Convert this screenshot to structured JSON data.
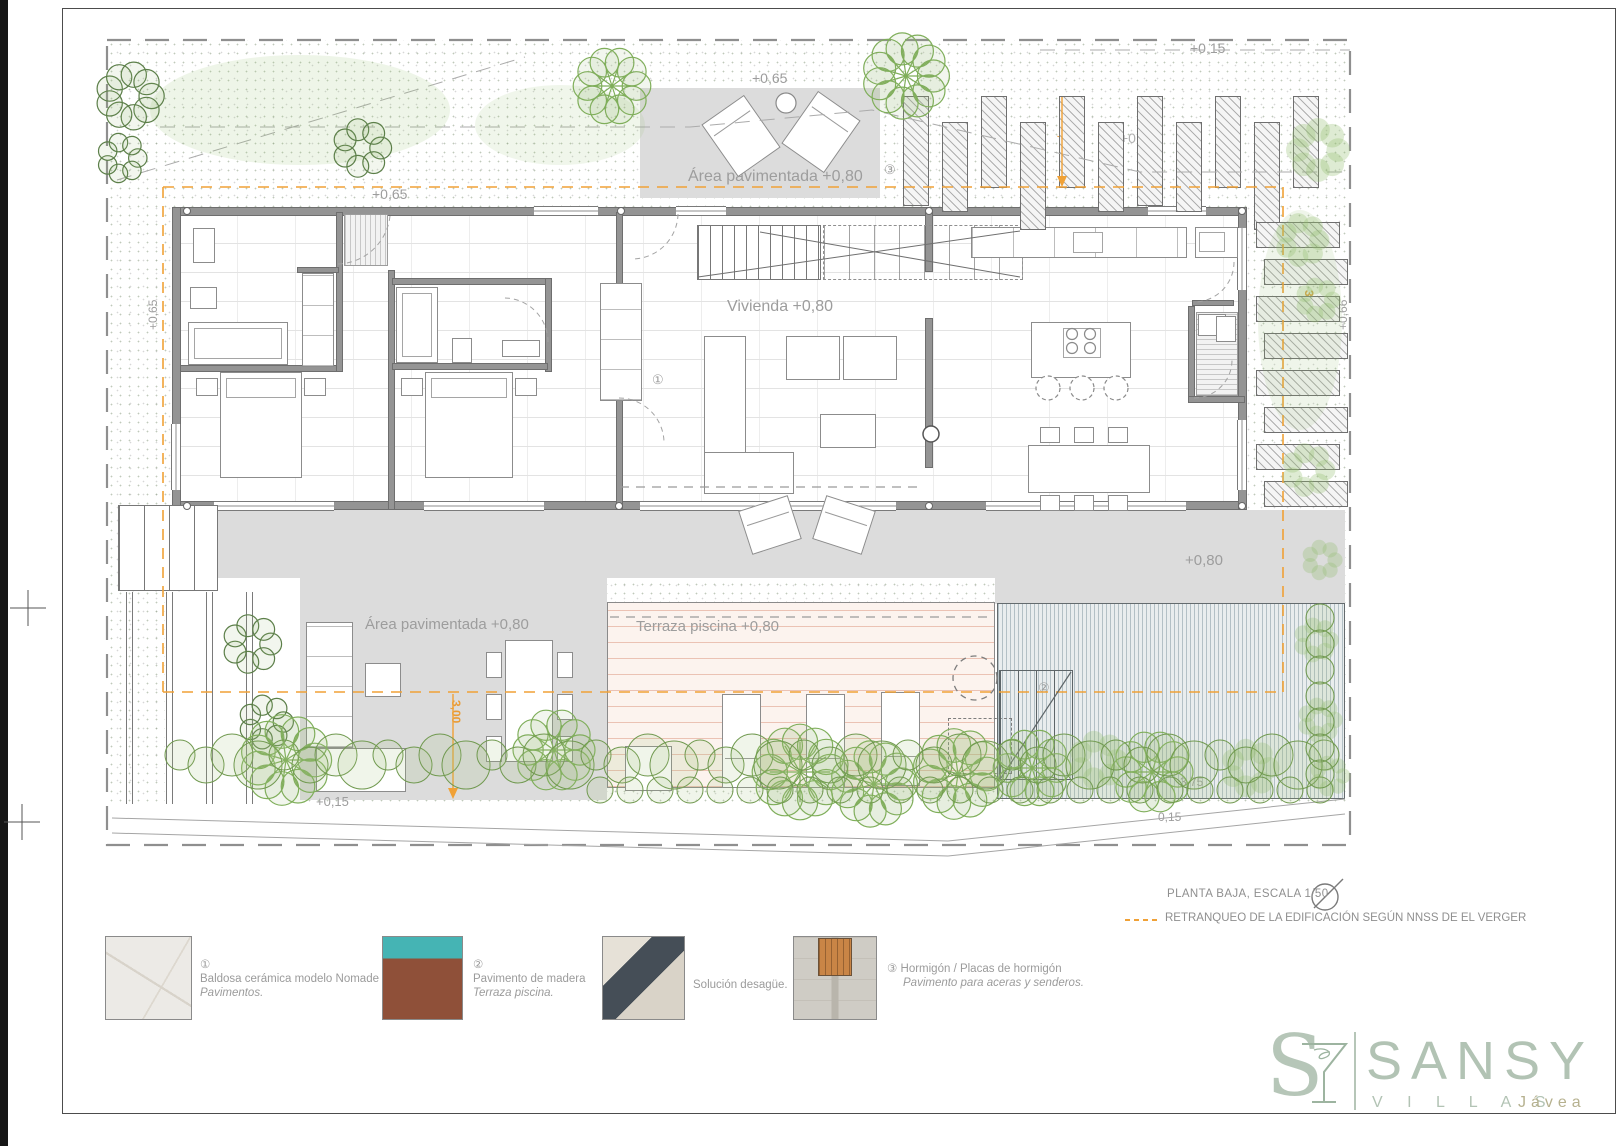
{
  "plan": {
    "labels": {
      "area_pavimentada_top": "Área pavimentada +0,80",
      "vivienda": "Vivienda +0,80",
      "area_pavimentada_left": "Área pavimentada +0,80",
      "terraza_piscina": "Terraza piscina +0,80",
      "level_080": "+0,80",
      "level_065_topleft": "+0,65",
      "level_065_pergola": "+0,65",
      "level_065_left": "+0,65",
      "level_015_top": "+0,15",
      "level_086": "+0,86",
      "level_066_right": "+0,66",
      "level_063": "+0,63",
      "level_047": "+0,47",
      "level_031": "+0,31",
      "level_015_bottom": "+0,15",
      "dim_300_top": "3,00",
      "dim_300_right": "3,00",
      "dim_300_bottom": "3,00",
      "dim_375": "3,75",
      "dim_015": "0,15",
      "marker_1": "①",
      "marker_2": "②",
      "marker_3": "③"
    },
    "title": "PLANTA BAJA,  ESCALA 1/50",
    "retranqueo_note": "RETRANQUEO DE LA EDIFICACIÓN SEGÚN NNSS DE EL VERGER"
  },
  "legend": {
    "items": [
      {
        "num": "①",
        "line1": "Baldosa cerámica modelo Nomade",
        "line2": "Pavimentos."
      },
      {
        "num": "②",
        "line1": "Pavimento de madera",
        "line2": "Terraza piscina."
      },
      {
        "num": "",
        "line1": "Solución desagüe.",
        "line2": ""
      },
      {
        "num": "③",
        "line1": "Hormigón / Placas de hormigón",
        "line2": "Pavimento para aceras y senderos."
      }
    ]
  },
  "logo": {
    "monogram": "S",
    "name": "SANSY",
    "subtitle": "V I L L A S",
    "city": "Jávea"
  },
  "colors": {
    "accent_orange": "#e99b35",
    "foliage_green": "#7fae5a",
    "sage_logo": "#b2c3b4",
    "deck_salmon": "#d7876c",
    "pool_blue": "#7d949d",
    "paved_grey": "#dcdcdc"
  }
}
